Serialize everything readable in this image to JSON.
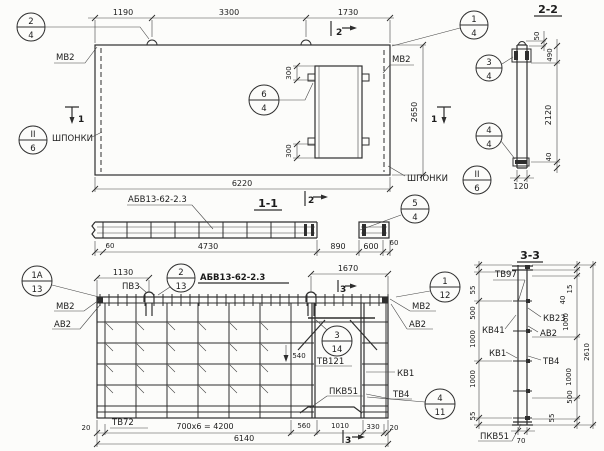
{
  "plan": {
    "dims": {
      "top1": "1190",
      "top2": "3300",
      "top3": "1730",
      "total": "6220",
      "height": "2650",
      "open_top": "300",
      "open_bot": "300"
    },
    "labels": {
      "mv2_left": "МВ2",
      "mv2_right": "МВ2",
      "shponki_left": "ШПОНКИ",
      "shponki_right": "ШПОНКИ"
    },
    "callouts": {
      "c24": [
        "2",
        "4"
      ],
      "c14": [
        "1",
        "4"
      ],
      "c64": [
        "6",
        "4"
      ],
      "cii6l": [
        "II",
        "6"
      ],
      "cii6r": [
        "II",
        "6"
      ]
    },
    "markers": {
      "m2": "2",
      "m1_left": "1",
      "m1_right": "1"
    }
  },
  "section22": {
    "title": "2-2",
    "dims": {
      "d50": "50",
      "d490": "490",
      "d2120": "2120",
      "d40": "40",
      "d120": "120"
    },
    "callouts": {
      "c34": [
        "3",
        "4"
      ],
      "c44": [
        "4",
        "4"
      ]
    }
  },
  "section11": {
    "title": "1-1",
    "beam_label": "АБВ13-62-2.3",
    "dims": {
      "d60l": "60",
      "d4730": "4730",
      "d890": "890",
      "d600": "600",
      "d60r": "60"
    },
    "callouts": {
      "c54": [
        "5",
        "4"
      ]
    },
    "marker2": "2"
  },
  "mesh": {
    "title": "АБВ13-62-2.3",
    "dims": {
      "d1130": "1130",
      "d1670": "1670",
      "d540": "540",
      "d20l": "20",
      "d700x6": "700x6 = 4200",
      "d560": "560",
      "d1010": "1010",
      "d330": "330",
      "d20r": "20",
      "total": "6140"
    },
    "labels": {
      "pv3": "ПВ3",
      "mv2_left": "МВ2",
      "av2_left": "АВ2",
      "mv2_right": "МВ2",
      "av2_right": "АВ2",
      "tv121": "ТВ121",
      "kv1": "КВ1",
      "tv4": "ТВ4",
      "pkv51": "ПКВ51",
      "tv72": "ТВ72"
    },
    "callouts": {
      "c1a13": [
        "1А",
        "13"
      ],
      "c213": [
        "2",
        "13"
      ],
      "c112": [
        "1",
        "12"
      ],
      "c314": [
        "3",
        "14"
      ],
      "c411": [
        "4",
        "11"
      ]
    },
    "marker3": "3"
  },
  "section33": {
    "title": "3-3",
    "dims_left": [
      "55",
      "500",
      "1000",
      "1000",
      "55"
    ],
    "dims_right": [
      "15",
      "40",
      "1000",
      "1000",
      "500",
      "55"
    ],
    "total": "2610",
    "d70": "70",
    "labels": {
      "tv97": "ТВ97",
      "kv41": "КВ41",
      "kv1": "КВ1",
      "kv23": "КВ23",
      "av2": "АВ2",
      "tv4": "ТВ4",
      "pkv51": "ПКВ51"
    }
  }
}
